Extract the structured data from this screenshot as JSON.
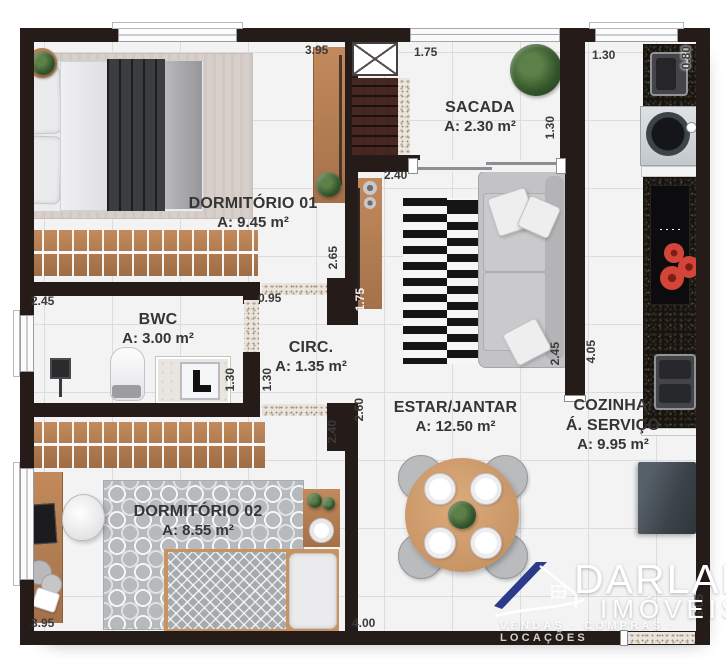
{
  "rooms": [
    {
      "name": "DORMITÓRIO 01",
      "area": "A: 9.45 m²"
    },
    {
      "name": "SACADA",
      "area": "A: 2.30 m²"
    },
    {
      "name": "BWC",
      "area": "A: 3.00 m²"
    },
    {
      "name": "CIRC.",
      "area": "A: 1.35 m²"
    },
    {
      "name": "ESTAR/JANTAR",
      "area": "A: 12.50 m²"
    },
    {
      "name": "COZINHA/",
      "name2": "Á. SERVIÇO",
      "area": "A: 9.95 m²"
    },
    {
      "name": "DORMITÓRIO 02",
      "area": "A: 8.55 m²"
    }
  ],
  "dims": [
    {
      "v": "3.95"
    },
    {
      "v": "1.75"
    },
    {
      "v": "1.30"
    },
    {
      "v": "0.80"
    },
    {
      "v": "1.30"
    },
    {
      "v": "2.40"
    },
    {
      "v": "2.65"
    },
    {
      "v": "1.75"
    },
    {
      "v": "2.45"
    },
    {
      "v": "0.95"
    },
    {
      "v": "1.30"
    },
    {
      "v": "1.30"
    },
    {
      "v": "2.40"
    },
    {
      "v": "2.60"
    },
    {
      "v": "2.45"
    },
    {
      "v": "4.05"
    },
    {
      "v": "3.95"
    },
    {
      "v": "4.00"
    },
    {
      "v": "6.05"
    }
  ],
  "watermark": {
    "brand": "DARLAN",
    "word": "IMÓVEIS",
    "tagline": "VENDAS · COMPRAS · LOCAÇÕES"
  },
  "colors": {
    "wall": "#251c1a",
    "floor": "#f3f3f4",
    "wood": "#bb8257",
    "granite": "#17140f",
    "burner_red": "#cf4437",
    "logo_blue": "#2c3a8c",
    "label_text": "#3a3a3a"
  }
}
